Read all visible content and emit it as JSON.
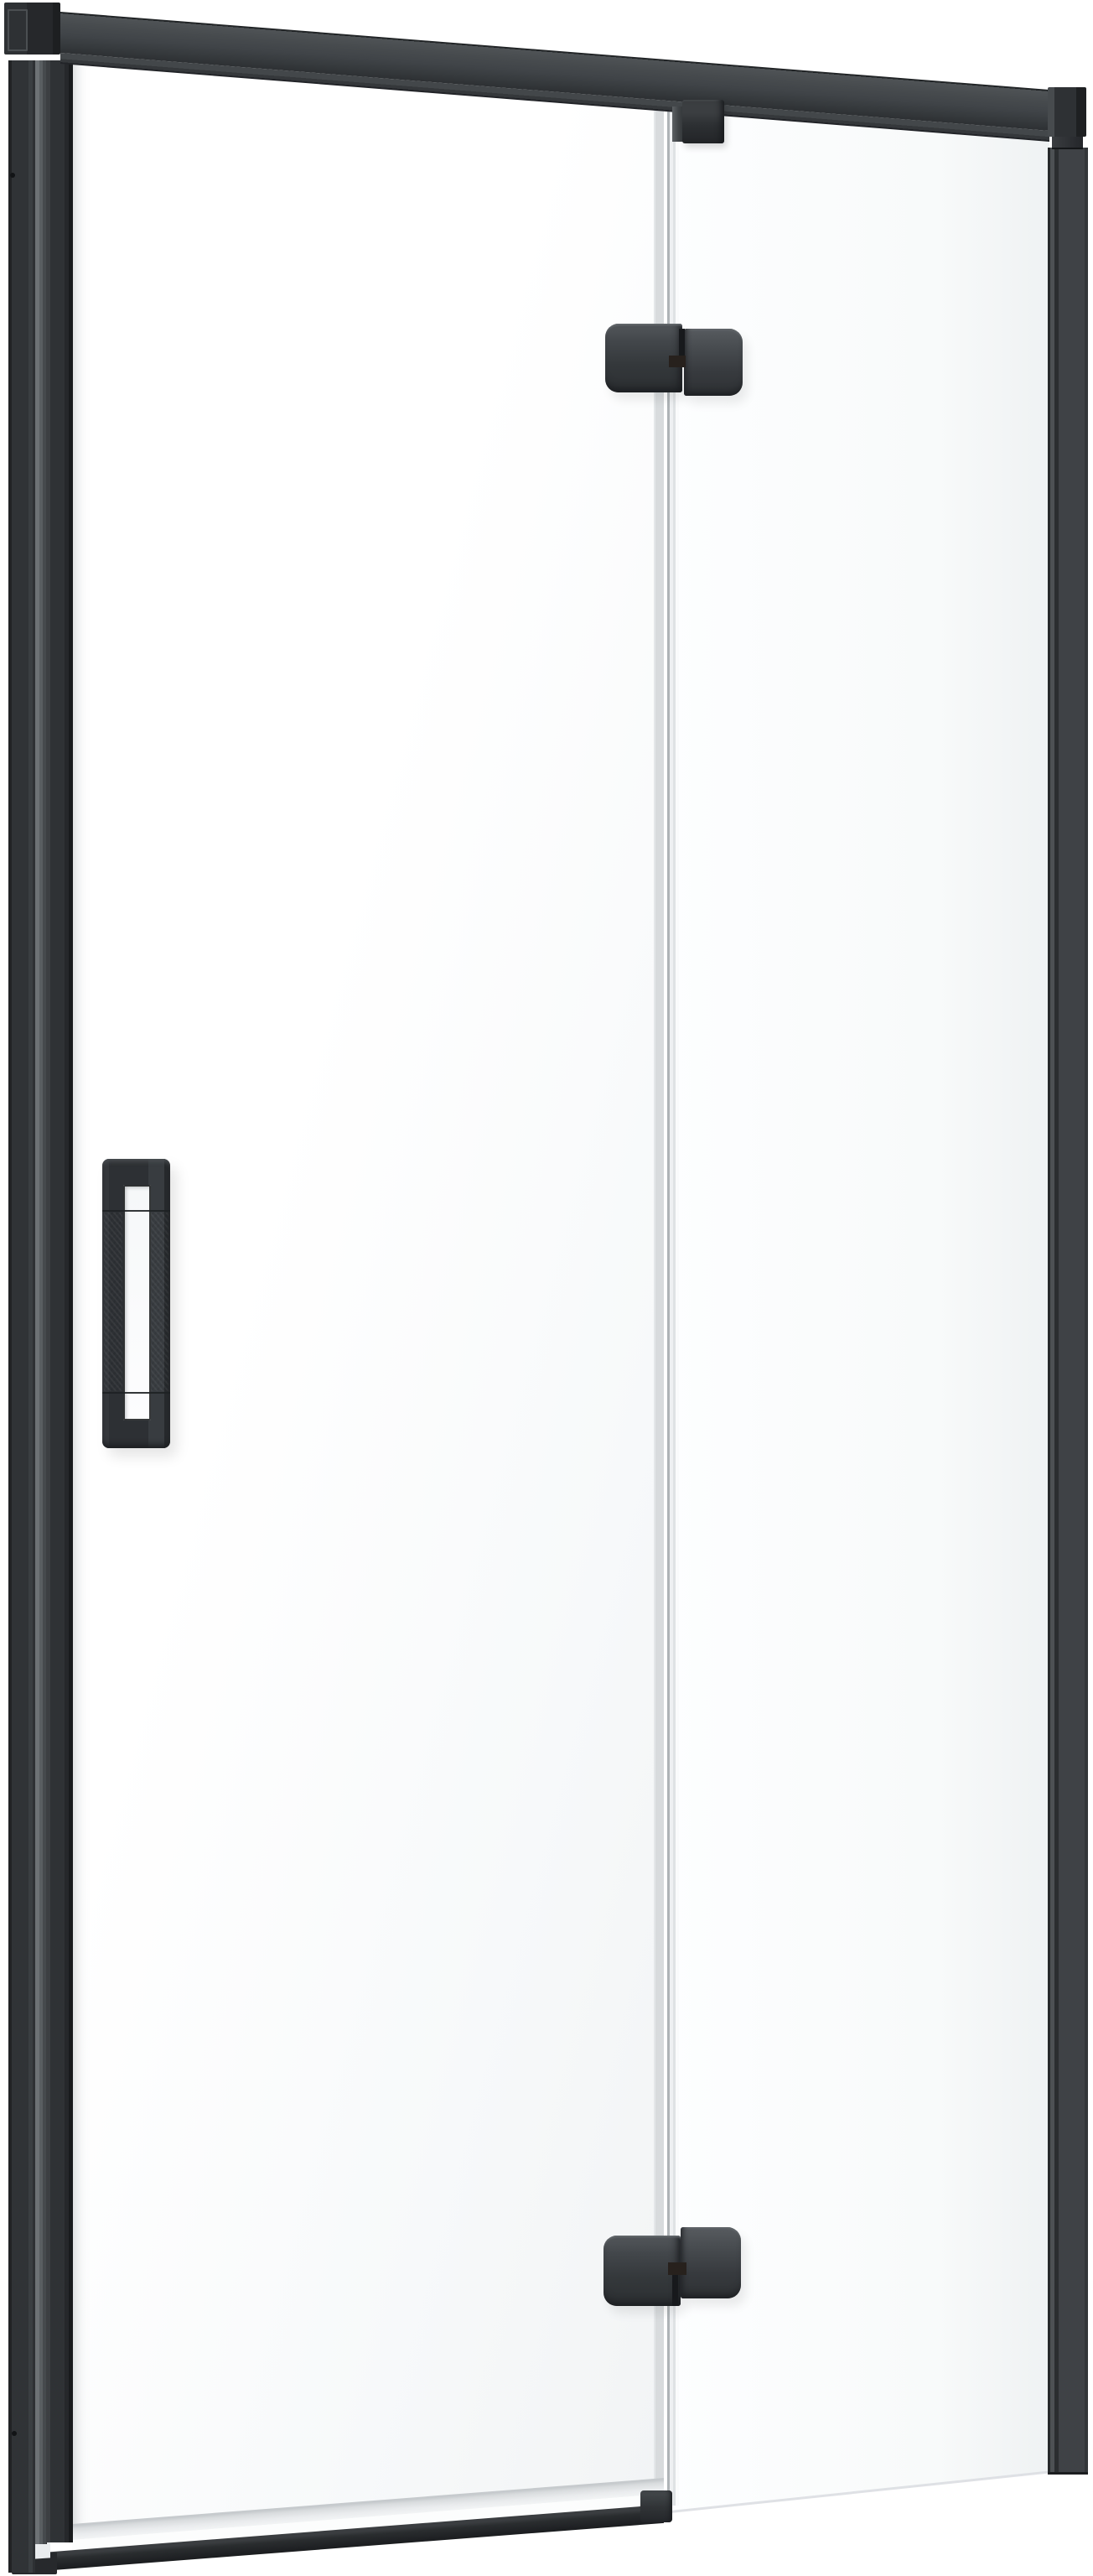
{
  "scene": {
    "kind": "product-render",
    "subject": "hinged glass shower door with matte black frame, closed, three-quarter front view on white background",
    "background": "#ffffff"
  },
  "theme": {
    "ink-1": "#17191b",
    "ink-2": "#202224",
    "ink-3": "#2b2e31",
    "ink-4": "#34373a",
    "ink-5": "#3f4246",
    "ink-6": "#4c5053",
    "ink-7": "#5b5f63",
    "channel-hi": "#6d7275",
    "glass-1": "#ffffff",
    "glass-2": "#f2f4f5",
    "seam-light": "#d8dbdd",
    "seam-line": "#aeb3b6",
    "seal-1": "#c6cacd",
    "seal-2": "#e9ebed",
    "bg": "#ffffff"
  },
  "parts": {
    "stage": "Shower door product render",
    "top_rail": "Top support rail",
    "top_rail_lip": "Top rail underside",
    "left_end_cap": "Left rail end cap",
    "right_end_cap": "Right rail end cap",
    "right_collar": "Right profile collar",
    "left_wall_profile": "Left wall profile",
    "right_wall_profile": "Right wall profile",
    "glass_channel": "Wall profile glass channel",
    "door_frame": "Door handle-side profile",
    "door_glass": "Hinged door glass panel",
    "fixed_glass": "Fixed side glass panel",
    "glass_seam": "Door-to-fixed-panel glass seam",
    "hinge_top": "Upper glass hinge",
    "hinge_bottom": "Lower glass hinge",
    "top_clamp": "Top panel clamp bracket",
    "handle": "Vertical pull handle",
    "handle_opening": "Handle grip opening",
    "bottom_seal": "Door bottom seal strip",
    "bottom_rail": "Door bottom rail",
    "bottom_rail_cap": "Bottom rail end cap",
    "floor_line": "Fixed panel floor edge",
    "screw_hole": "Profile screw hole"
  }
}
